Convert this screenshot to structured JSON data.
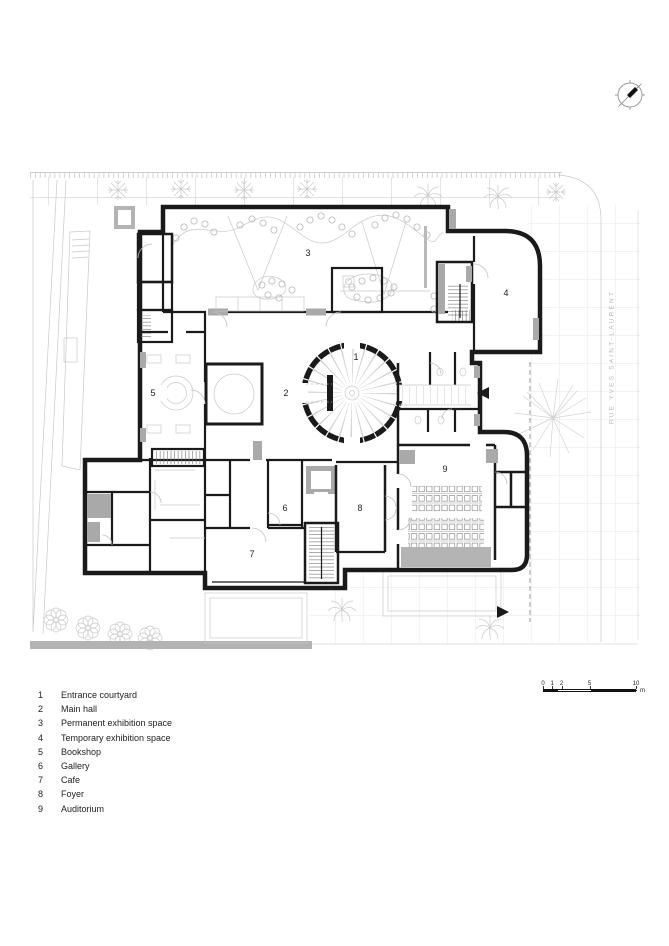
{
  "page": {
    "background": "#ffffff"
  },
  "site": {
    "street_label": "RUE YVES SAINT-LAURENT"
  },
  "legend": {
    "items": [
      {
        "number": "1",
        "label": "Entrance courtyard"
      },
      {
        "number": "2",
        "label": "Main hall"
      },
      {
        "number": "3",
        "label": "Permanent exhibition space"
      },
      {
        "number": "4",
        "label": "Temporary exhibition space"
      },
      {
        "number": "5",
        "label": "Bookshop"
      },
      {
        "number": "6",
        "label": "Gallery"
      },
      {
        "number": "7",
        "label": "Cafe"
      },
      {
        "number": "8",
        "label": "Foyer"
      },
      {
        "number": "9",
        "label": "Auditorium"
      }
    ]
  },
  "scale_bar": {
    "ticks": [
      "0",
      "1",
      "2",
      "5",
      "10"
    ],
    "unit": "m"
  },
  "icons": {
    "north_arrow": "compass-north",
    "entrance_arrow_left": "triangle-left",
    "entrance_arrow_right": "triangle-right"
  },
  "colors": {
    "wall": "#1a1a1a",
    "poche": "#a9a9a9",
    "site": "#c8c8c8",
    "site_light": "#d9d9d9",
    "stage": "#b4b4b4",
    "text": "#222222",
    "label": "#b9b9b9"
  }
}
